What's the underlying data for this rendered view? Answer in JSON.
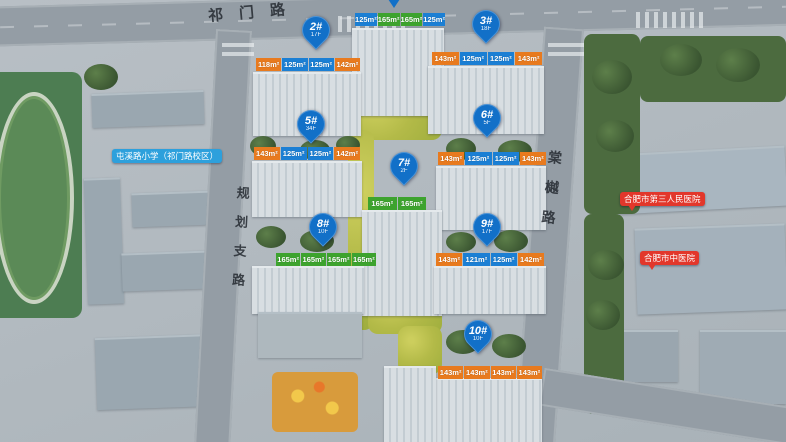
{
  "roads": {
    "top_label": "祁门路",
    "left_label": "规划支路",
    "right_label": "棠樾路"
  },
  "landmarks": {
    "school": "屯溪路小学（祁门路校区）",
    "hospital_1": "合肥市第三人民医院",
    "hospital_2": "合肥市中医院"
  },
  "top_building": {
    "tags": [
      {
        "t": "125m²",
        "c": "blue"
      },
      {
        "t": "165m²",
        "c": "green"
      },
      {
        "t": "165m²",
        "c": "green"
      },
      {
        "t": "125m²",
        "c": "blue"
      }
    ]
  },
  "buildings": [
    {
      "pin": "2#",
      "floors": "17F",
      "tags": [
        {
          "t": "118m²",
          "c": "orange"
        },
        {
          "t": "125m²",
          "c": "blue"
        },
        {
          "t": "125m²",
          "c": "blue"
        },
        {
          "t": "142m²",
          "c": "orange"
        }
      ]
    },
    {
      "pin": "3#",
      "floors": "18F",
      "tags": [
        {
          "t": "143m²",
          "c": "orange"
        },
        {
          "t": "125m²",
          "c": "blue"
        },
        {
          "t": "125m²",
          "c": "blue"
        },
        {
          "t": "143m²",
          "c": "orange"
        }
      ]
    },
    {
      "pin": "5#",
      "floors": "34F",
      "tags": [
        {
          "t": "143m²",
          "c": "orange"
        },
        {
          "t": "125m²",
          "c": "blue"
        },
        {
          "t": "125m²",
          "c": "blue"
        },
        {
          "t": "142m²",
          "c": "orange"
        }
      ]
    },
    {
      "pin": "6#",
      "floors": "5F",
      "tags": [
        {
          "t": "143m²",
          "c": "orange"
        },
        {
          "t": "125m²",
          "c": "blue"
        },
        {
          "t": "125m²",
          "c": "blue"
        },
        {
          "t": "143m²",
          "c": "orange"
        }
      ]
    },
    {
      "pin": "7#",
      "floors": "2F",
      "tags": [
        {
          "t": "165m²",
          "c": "green"
        },
        {
          "t": "165m²",
          "c": "green"
        }
      ]
    },
    {
      "pin": "8#",
      "floors": "10F",
      "tags": [
        {
          "t": "165m²",
          "c": "green"
        },
        {
          "t": "165m²",
          "c": "green"
        },
        {
          "t": "165m²",
          "c": "green"
        },
        {
          "t": "165m²",
          "c": "green"
        }
      ]
    },
    {
      "pin": "9#",
      "floors": "17F",
      "tags": [
        {
          "t": "143m²",
          "c": "orange"
        },
        {
          "t": "121m²",
          "c": "blue"
        },
        {
          "t": "125m²",
          "c": "blue"
        },
        {
          "t": "142m²",
          "c": "orange"
        }
      ]
    },
    {
      "pin": "10#",
      "floors": "10F",
      "tags": [
        {
          "t": "143m²",
          "c": "orange"
        },
        {
          "t": "143m²",
          "c": "orange"
        },
        {
          "t": "143m²",
          "c": "orange"
        },
        {
          "t": "143m²",
          "c": "orange"
        }
      ]
    }
  ],
  "colors": {
    "pin_blue": "#1270c8",
    "tag_orange": "#e87a1e",
    "tag_blue": "#1b7fd4",
    "tag_green": "#3da32e",
    "landmark_red": "#e2372b",
    "landmark_blue": "#2da0dc"
  }
}
